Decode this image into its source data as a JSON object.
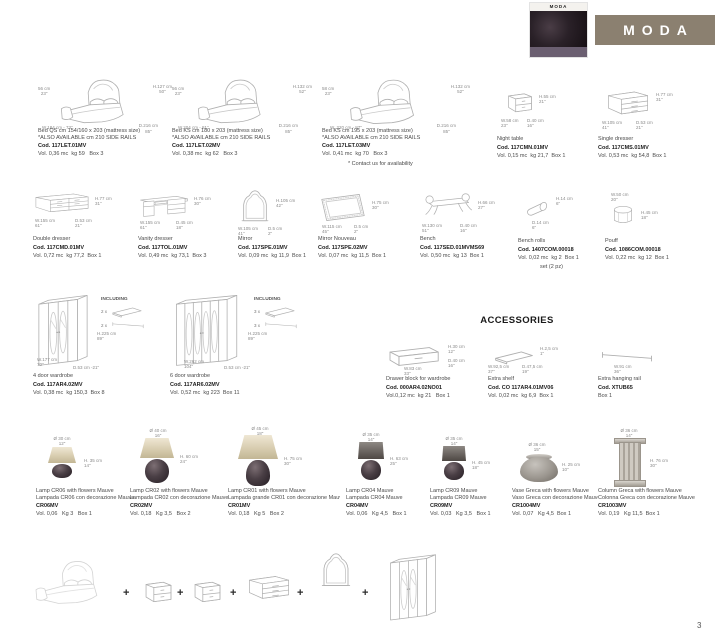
{
  "header": {
    "banner_label": "MODA",
    "banner_color": "#8b8070",
    "thumb_brand": "MODA"
  },
  "page_number": "3",
  "accessories_title": "ACCESSORIES",
  "beds": [
    {
      "dim_side": "56 cm\n23\"",
      "dim_h": "H.127 cm\n50\"",
      "dim_w": "W.184 cm - 73\"",
      "dim_d": "D.216 cm\n85\"",
      "name": "Bed QS cm 154/160 x 203 (mattress size)",
      "note": "*ALSO AVAILABLE cm 210 SIDE RAILS",
      "code": "Cod. 117LET.01MV",
      "vol": "Vol. 0,36 mc  kg 59   Box 3"
    },
    {
      "dim_side": "56 cm\n23\"",
      "dim_h": "H.132 cm\n52\"",
      "dim_w": "W.204 cm - 81\"",
      "dim_d": "D.216 cm\n85\"",
      "name": "Bed KS cm 180 x 203 (mattress size)",
      "note": "*ALSO AVAILABLE cm 210 SIDE RAILS",
      "code": "Cod. 117LET.02MV",
      "vol": "Vol. 0,38 mc  kg 62   Box 3"
    },
    {
      "dim_side": "58 cm\n23\"",
      "dim_h": "H.132 cm\n52\"",
      "dim_w": "W. 220 cm - 87\"",
      "dim_d": "D.216 cm\n85\"",
      "name": "Bed KS cm 195 x 203 (mattress size)",
      "note": "*ALSO AVAILABLE cm 210 SIDE RAILS",
      "code": "Cod. 117LET.03MV",
      "vol": "Vol. 0,41 mc  kg 70   Box 3",
      "contact": "* Contact us for availability"
    }
  ],
  "night_table": {
    "name": "Night table",
    "code": "Cod. 117CMN.01MV",
    "vol": "Vol. 0,15 mc  kg 21,7  Box 1",
    "dim_h": "H.55 cm\n21\"",
    "dim_w": "W.58 cm\n23\"",
    "dim_d": "D.40 cm\n16\""
  },
  "single_dresser": {
    "name": "Single dresser",
    "code": "Cod. 117CMS.01MV",
    "vol": "Vol. 0,53 mc  kg 54,8  Box 1",
    "dim_h": "H.77 cm\n31\"",
    "dim_w": "W.105 cm\n41\"",
    "dim_d": "D.53 cm\n21\""
  },
  "double_dresser": {
    "name": "Double dresser",
    "code": "Cod. 117CMD.01MV",
    "vol": "Vol. 0,72 mc  kg 77,2  Box 1",
    "dim_h": "H.77 cm\n31\"",
    "dim_w": "W.155 cm\n61\"",
    "dim_d": "D.53 cm\n21\""
  },
  "vanity_dresser": {
    "name": "Vanity dresser",
    "code": "Cod. 117TOL.01MV",
    "vol": "Vol. 0,49 mc  kg 73,1  Box 3",
    "dim_h": "H.76 cm\n30\"",
    "dim_w": "W.155 cm\n61\"",
    "dim_d": "D.45 cm\n18\""
  },
  "mirror": {
    "name": "Mirror",
    "code": "Cod. 117SPE.01MV",
    "vol": "Vol. 0,09 mc  kg 11,9  Box 1",
    "dim_h": "H.105 cm\n42\"",
    "dim_w": "W.105 cm\n41\"",
    "dim_d": "D.5 cm\n2\""
  },
  "mirror_nouveau": {
    "name": "Mirror Nouveau",
    "code": "Cod. 117SPE.02MV",
    "vol": "Vol. 0,07 mc  kg 11,5  Box 1",
    "dim_h": "H.75 cm\n30\"",
    "dim_w": "W.115 cm\n45\"",
    "dim_d": "D.5 cm\n2\""
  },
  "bench": {
    "name": "Bench",
    "code": "Cod. 117SED.01MVMS69",
    "vol": "Vol. 0,50 mc  kg 13  Box 1",
    "dim_h": "H.66 cm\n27\"",
    "dim_w": "W.130 cm\n51\"",
    "dim_d": "D.40 cm\n16\""
  },
  "bench_rolls": {
    "name": "Bench rolls",
    "code": "Cod. 1407COM.00018",
    "vol": "Vol. 0,02 mc  kg 2  Box 1",
    "set": "set (2 pz)",
    "dim_h": "H.14 cm\n6\"",
    "dim_d": "D.14 cm\n6\""
  },
  "pouf": {
    "name": "Pouff",
    "code": "Cod. 1086COM.00018",
    "vol": "Vol. 0,22 mc  kg 12  Box 1",
    "dim_w": "W.50 cm\n20\"",
    "dim_h": "H.45 cm\n18\""
  },
  "wardrobe4": {
    "name": "4 door wardrobe",
    "code": "Cod. 117AR4.02MV",
    "vol": "Vol. 0,38 mc  kg 150,3  Box 8",
    "including": "INCLUDING",
    "inc_shelf": "2 x",
    "inc_rail": "2 x",
    "dim_h": "H.225 cm\n89\"",
    "dim_w": "W.177 cm\n70\"",
    "dim_d": "D.53 cm -21\""
  },
  "wardrobe6": {
    "name": "6 door wardrobe",
    "code": "Cod. 117AR6.02MV",
    "vol": "Vol. 0,52 mc  kg 223  Box 11",
    "including": "INCLUDING",
    "inc_shelf": "3 x",
    "inc_rail": "3 x",
    "dim_h": "H.225 cm\n89\"",
    "dim_w": "W.262 cm\n104\"",
    "dim_d": "D.53 cm -21\""
  },
  "drawer_block": {
    "name": "Drawer block for wardrobe",
    "code": "Cod. 000AR4.02NO01",
    "vol": "Vol.0,12 mc  kg 21   Box 1",
    "dim_h": "H.30 cm\n12\"",
    "dim_w": "W.83 cm\n33\"",
    "dim_d": "D.40 cm\n16\""
  },
  "extra_shelf": {
    "name": "Extra shelf",
    "code": "Cod. CO 117AR4.01MV06",
    "vol": "Vol. 0,02 mc  kg 6,9  Box 1",
    "dim_h": "H.2,5 cm\n1\"",
    "dim_w": "W.92,5 cm\n37\"",
    "dim_d": "D.47,5 cm\n19\""
  },
  "extra_rail": {
    "name": "Extra hanging rail",
    "code": "Cod. XTUB65",
    "vol": "Box 1",
    "dim_w": "W.91 cm\n36\""
  },
  "lamps": [
    {
      "name": "Lamp CR06 with flowers Mauve",
      "name_it": "Lampada CR06 con decorazione Mauve",
      "code": "CR06MV",
      "vol": "Vol. 0,06   Kg 3   Box 1",
      "dim_dia": "Ø 30 cm\n12\"",
      "dim_h": "H. 35 cm\n14\""
    },
    {
      "name": "Lamp CR02 with flowers Mauve",
      "name_it": "Lampada CR02 con decorazione Mauve",
      "code": "CR02MV",
      "vol": "Vol. 0,18   Kg 3,5   Box 2",
      "dim_dia": "Ø 40 cm\n16\"",
      "dim_h": "H. 60 cm\n24\""
    },
    {
      "name": "Lamp CR01 with flowers Mauve",
      "name_it": "Lampada grande CR01 con decorazione Mauve",
      "code": "CR01MV",
      "vol": "Vol. 0,18   Kg 5   Box 2",
      "dim_dia": "Ø 45 cm\n18\"",
      "dim_h": "H. 75 cm\n30\""
    },
    {
      "name": "Lamp CR04 Mauve",
      "name_it": "Lampada CR04 Mauve",
      "code": "CR04MV",
      "vol": "Vol. 0,06   Kg 4,5   Box 1",
      "dim_dia": "Ø 35 cm\n14\"",
      "dim_h": "H. 63 cm\n25\""
    },
    {
      "name": "Lamp CR09 Mauve",
      "name_it": "Lampada CR09 Mauve",
      "code": "CR09MV",
      "vol": "Vol. 0,03   Kg 3,5   Box 1",
      "dim_dia": "Ø 35 cm\n14\"",
      "dim_h": "H. 45 cm\n18\""
    }
  ],
  "vase": {
    "name": "Vase Greca with flowers Mauve",
    "name_it": "Vaso Greca con decorazione Mauve",
    "code": "CR1004MV",
    "vol": "Vol. 0,07   Kg 4,5  Box 1",
    "dim_dia": "Ø 36 cm\n15\"",
    "dim_h": "H. 25 cm\n10\""
  },
  "column": {
    "name": "Column Greca with flowers Mauve",
    "name_it": "Colonna Greca con decorazione Mauve",
    "code": "CR1003MV",
    "vol": "Vol. 0,19   Kg 11,5  Box 1",
    "dim_dia": "Ø 36 cm\n14\"",
    "dim_h": "H. 76 cm\n30\""
  },
  "composition": {
    "plus": "+"
  }
}
